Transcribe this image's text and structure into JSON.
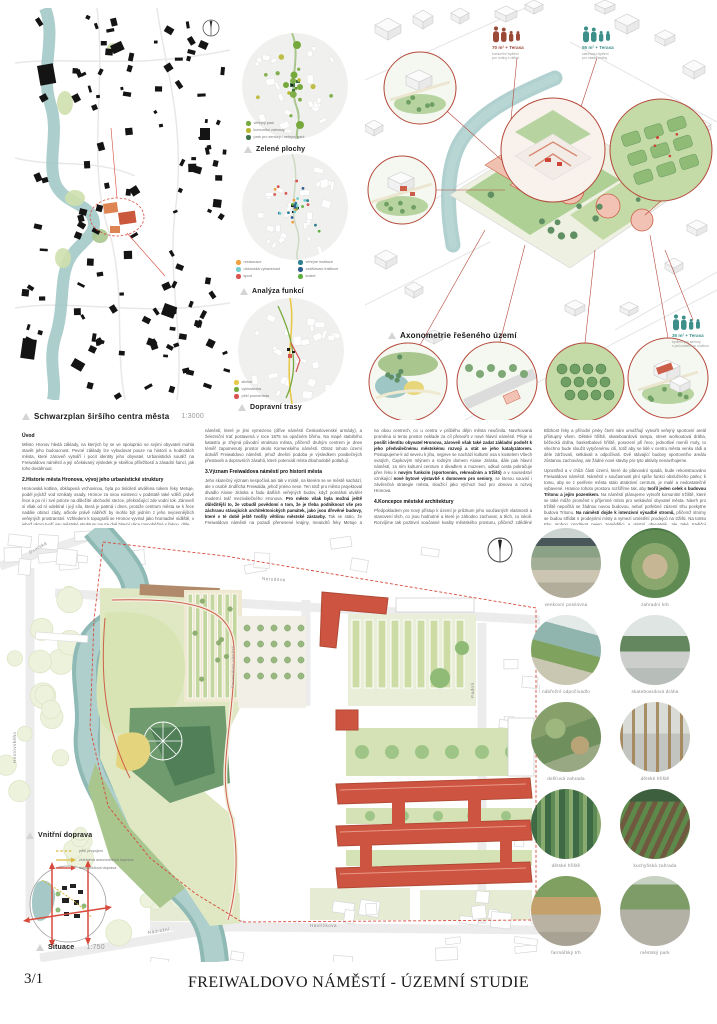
{
  "poster": {
    "number": "3/1",
    "title": "FREIWALDOVO NÁMĚSTÍ - ÚZEMNÍ STUDIE"
  },
  "schwarzplan": {
    "heading": "Schwarzplan širšího centra města",
    "scale": "1:3000"
  },
  "diagrams": {
    "green": {
      "heading": "Zelené plochy",
      "legend": [
        {
          "label": "veřejný park",
          "color": "#76a93c"
        },
        {
          "label": "komunitní zahrady",
          "color": "#b8b832"
        },
        {
          "label": "park pro seniory / veřejný park",
          "color": "#3e7249"
        }
      ]
    },
    "functions": {
      "heading": "Analýza funkcí",
      "legend": [
        {
          "label": "restaurace",
          "color": "#f0a03c"
        },
        {
          "label": "občanská vybavenost",
          "color": "#72cfcf"
        },
        {
          "label": "sport",
          "color": "#d9534f"
        },
        {
          "label": "veřejné instituce",
          "color": "#2e7f8f"
        },
        {
          "label": "vzdělávací instituce",
          "color": "#2d5d8f"
        },
        {
          "label": "kostel",
          "color": "#5fae3f"
        }
      ]
    },
    "transport": {
      "heading": "Dopravní trasy",
      "legend": [
        {
          "label": "silnice",
          "color": "#e8c84a"
        },
        {
          "label": "cyklostezka",
          "color": "#76a93c"
        },
        {
          "label": "pěší promenáda",
          "color": "#d9534f"
        }
      ]
    }
  },
  "axonometry": {
    "heading": "Axonometrie řešeného území",
    "callouts": [
      {
        "label": "70 m² + Terasa",
        "line1": "komunitní bydlení",
        "line2": "pro rodiny s dětmi",
        "color": "#9c4a38"
      },
      {
        "label": "55 m² + Terasa",
        "line1": "startovací bydlení",
        "line2": "pro mladé rodiny",
        "color": "#3d8f8a"
      },
      {
        "label": "35 m² + Terasa",
        "line1": "bydlení pro seniory",
        "line2": "s pečovatelskou službou",
        "color": "#3d8f8a"
      }
    ]
  },
  "essay": {
    "col1": {
      "h1": "Úvod",
      "p1": "Město Hronov hledá základy, na kterých by se ve spolupráci se svými obyvateli mohla stavět jeho budoucnost. Pevné základy lze vybudovat pouze na historii a hodnotách města, které zároveň vytváří i pocit identity jeho obyvatel. Urbanistická soutěž na Freiwaldovo náměstí a její očekávaný výsledek je skvělou příležitostí a zásadní šancí, jak toho dosáhnout.",
      "h2": "2.Historie města Hronova, vývoj jeho urbanistické struktury",
      "p2": "Hronovská kotlina, obklopená vrchovinou, byla po tisíciletí utvářena tokem řeky Metuje, podél jejíchž vod vznikaly osady. Hronov za svou existenci v podstatě také vděčí právě řece a po ní i své poloze na důležité obchodní stezce, překračující zde vodní tok. Zároveň si však od ní odebíral i její sílu, která je patrná i dnes, protože centrum města se k řece nadále obrací zády, ačkoliv právě nábřeží by mohlo být jedním z jeho nejcennějších veřejných prostranství. Vzhledem k topografii se Hronov vyvinul jako hromadné sídliště, v jehož rámci tvoří osy městské struktury pouze dvě hlavní ulice rovnoběžné s řekou, dále"
    },
    "col2": {
      "p1": "náměstí, které je jimi vymezeno (dříve náměstí Československé armády), a železniční trať postavená v roce 1875 na opačném břehu. Na mapě stabilního katastru je zřejmá původní struktura města, přičemž druhým centrem je dnes téměř zapomenutý prostor okolo Komenského náměstí. Obraz tohoto území dotváří Freiwaldovo náměstí, jehož dnešní podoba je výsledkem poválečných přestaveb a dopravních zásahů, které potenciál místa dlouhodobě potlačují.",
      "h1": "3.Význam Freiwaldova náměstí pro historii města",
      "p2a": "Jeho skutečný význam nespočívá ani tak v místě, na kterém se ve městě nachází, ale v osobě Jindřicha Freiwalda, jehož jméno nese. Ten totiž pro město projektoval divadlo Aloise Jiráska a řadu dalších veřejných budov, když pomáhal utvářet moderní tvář meziválečného Hronova. ",
      "p2b": "Pro město však byla možná ještě důležitější to, že vzbudil povědomí o tom, že je třeba podniknout vše pro záchranu stávajících architektonických památek, jako jsou dřevěné budovy, které v té době ještě tvořily většinu městské zástavby.",
      "p2c": " Tak se stalo, že Freiwaldovo náměstí na pozadí přenesené krajiny, meandrů řeky Metuje a několika dřevěných staveb dodnes vypráví příběh města a jeho obyvatel, který je možné dále rozvíjet."
    },
    "col3": {
      "p1a": "na obou centrech, co u centra v průběhu dějin města neučinila. Navrhovaná proměna si tento prostor neklade za cíl přetvořit v nové hlavní náměstí. Přeje si ",
      "p1b": "posílit identitu obyvatel Hronova, zároveň však také zadat základní podnět k jeho předválečnému městskému rozvoji a stát se jeho katalyzátorem.",
      "p1c": " Postupujeme-li od severu k jihu, nejprve se nachází kulturní osa s kostelem Všech svatých, Čapkovým mlýnem a rodným domem Aloise Jiráska, dále pak hlavní náměstí, za ním kulturní centrum s divadlem a muzeem, odkud cesta pokračuje přes řeku k ",
      "p1d": "novým funkcím (sportovním, rekreačním a tržišti)",
      "p1e": " a v sousedství vznikající ",
      "p1f": "nové bytové výstavbě s domovem pro seniory",
      "p1g": ", se kterou souvisí i závěrečná strategie města, sloužící jako výchozí bod pro obnovu a rozvoj Hronova.",
      "h1": "4.Koncepce městské architektury",
      "p2": "Předpokladem pro nový přístup k území je průzkum jeho současných vlastností a stanovení těch, co jsou hodnotné a které je záhodno zachovat, a těch, co nikoli. Rozvíjíme tak pozitivní současné kvality městského prostoru, přičemž zděděné hodnoty zdůrazňujeme a dbáme na jejich kontinuitu. O jaké hodnoty se ale jedná? Oblast mezi Nerudovou, Hostovského a Havlíčkovou ulicí a řekou Metují se vyznačuje nízkou zástavbou a především blízkostí řeky, která tvoří přirozenou páteř celého území."
    },
    "col4": {
      "p1": "Blízkost řeky a přírodní prvky čtvrti nám umožňují vytvořit veřejný sportovní areál přístupný všem. Dětské hřiště, skateboardová rampa, street workoutová dráha, běžecká dráha, basketbalové hřiště, posezení při řece, jednotlivé menší moly, to všechno bude sloužit vytyčenému cíli, totiž aby se lidé v centru města venku rádi a déle zdržovali, setkávali a odpočívali. Dvě stávající budovy sportovního areálu zůstanou zachovány, ale žádné nové stavby pro tyto aktivity nenavrhujeme.",
      "p2a": "Uprostřed a v chůzi části území, které do plánování spadá, bude rekonstruováno Freiwaldovo náměstí. Náměstí v současnosti plní spíše funkci obslužného parku; k tomu, aby se z periferie města stalo atraktivní centrum, je malé a nedostatečně vybavené. Hranice tohoto prostoru rozšíříme tak, aby ",
      "p2b": "tvořil jeden celek s budovou Tritonu a jejím pozemkem.",
      "p2c": " Na náměstí plánujeme vytvořit komunitní tržiště, které se také může proměnit v příjemné místo pro setkávání obyvatel města. Návrh pro tržiště nepočítá se žádnou novou budovou, neboť potřebné zázemí trhu poskytne budova Tritonu. ",
      "p2d": "Na náměstí dojde k intenzivní výsadbě stromů,",
      "p2e": " přičemž stromy se budou střídat s prodejními místy a vymezí umístění prodejců na tržišti. Na tomto trhu mohou prodávat nejen zemědělci a místní obyvatelé, ale také tradiční obchodníci."
    }
  },
  "siteplan": {
    "streets": {
      "dvorska": "Dvorská",
      "nerudova": "Nerudova",
      "hostovskeho": "Hostovského",
      "nadrazni": "Nádražní",
      "havlickova": "Havlíčkova",
      "padoli": "Padolí",
      "square": "Freiwaldovo náměstí"
    },
    "inner_transport": {
      "heading": "Vnitřní doprava",
      "legend": [
        {
          "label": "pěší propojení",
          "color": "#d9b93c"
        },
        {
          "label": "zklidněná automobilová doprava",
          "color": "#d9b93c"
        },
        {
          "label": "automobilová doprava",
          "color": "#d84b3c"
        }
      ]
    },
    "situace": {
      "label": "Situace",
      "scale": "1:750"
    }
  },
  "gallery": {
    "items": [
      {
        "label": "venkovní posilovna"
      },
      {
        "label": "zahradní krb"
      },
      {
        "label": "nábřežní odpočívadlo"
      },
      {
        "label": "skateboardová dráha"
      },
      {
        "label": "dešťová zahrada"
      },
      {
        "label": "dětské hřiště"
      },
      {
        "label": "dětské hřiště"
      },
      {
        "label": "kuchyňská zahrada"
      },
      {
        "label": "farmářský trh"
      },
      {
        "label": "městský park"
      }
    ]
  }
}
